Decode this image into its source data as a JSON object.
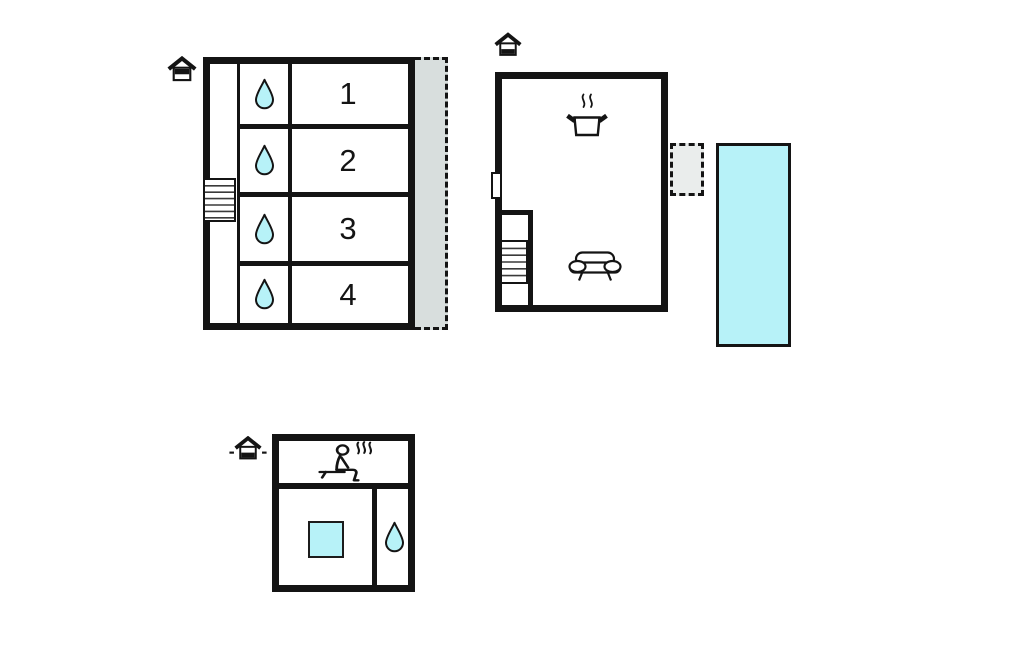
{
  "colors": {
    "wall": "#141414",
    "water": "#b7f2f8",
    "balcony": "#d8dedd",
    "porch": "#eaedec",
    "background": "#ffffff"
  },
  "bedroom_wing": {
    "floor_marker_icon": "house-upper-floor",
    "rooms": [
      {
        "number": "1",
        "icon": "water-drop"
      },
      {
        "number": "2",
        "icon": "water-drop"
      },
      {
        "number": "3",
        "icon": "water-drop"
      },
      {
        "number": "4",
        "icon": "water-drop"
      }
    ],
    "features": [
      "stairs",
      "corridor",
      "dashed-balcony"
    ]
  },
  "main_house": {
    "floor_marker_icon": "house-ground-floor",
    "features": [
      "cooking-pot-kitchen",
      "sofa-living-area",
      "stairs",
      "door-opening",
      "dashed-porch",
      "swimming-pool"
    ]
  },
  "annex": {
    "floor_marker_icon": "house-annex-ground-floor",
    "features": [
      "sauna",
      "plunge-pool",
      "water-drop"
    ]
  }
}
